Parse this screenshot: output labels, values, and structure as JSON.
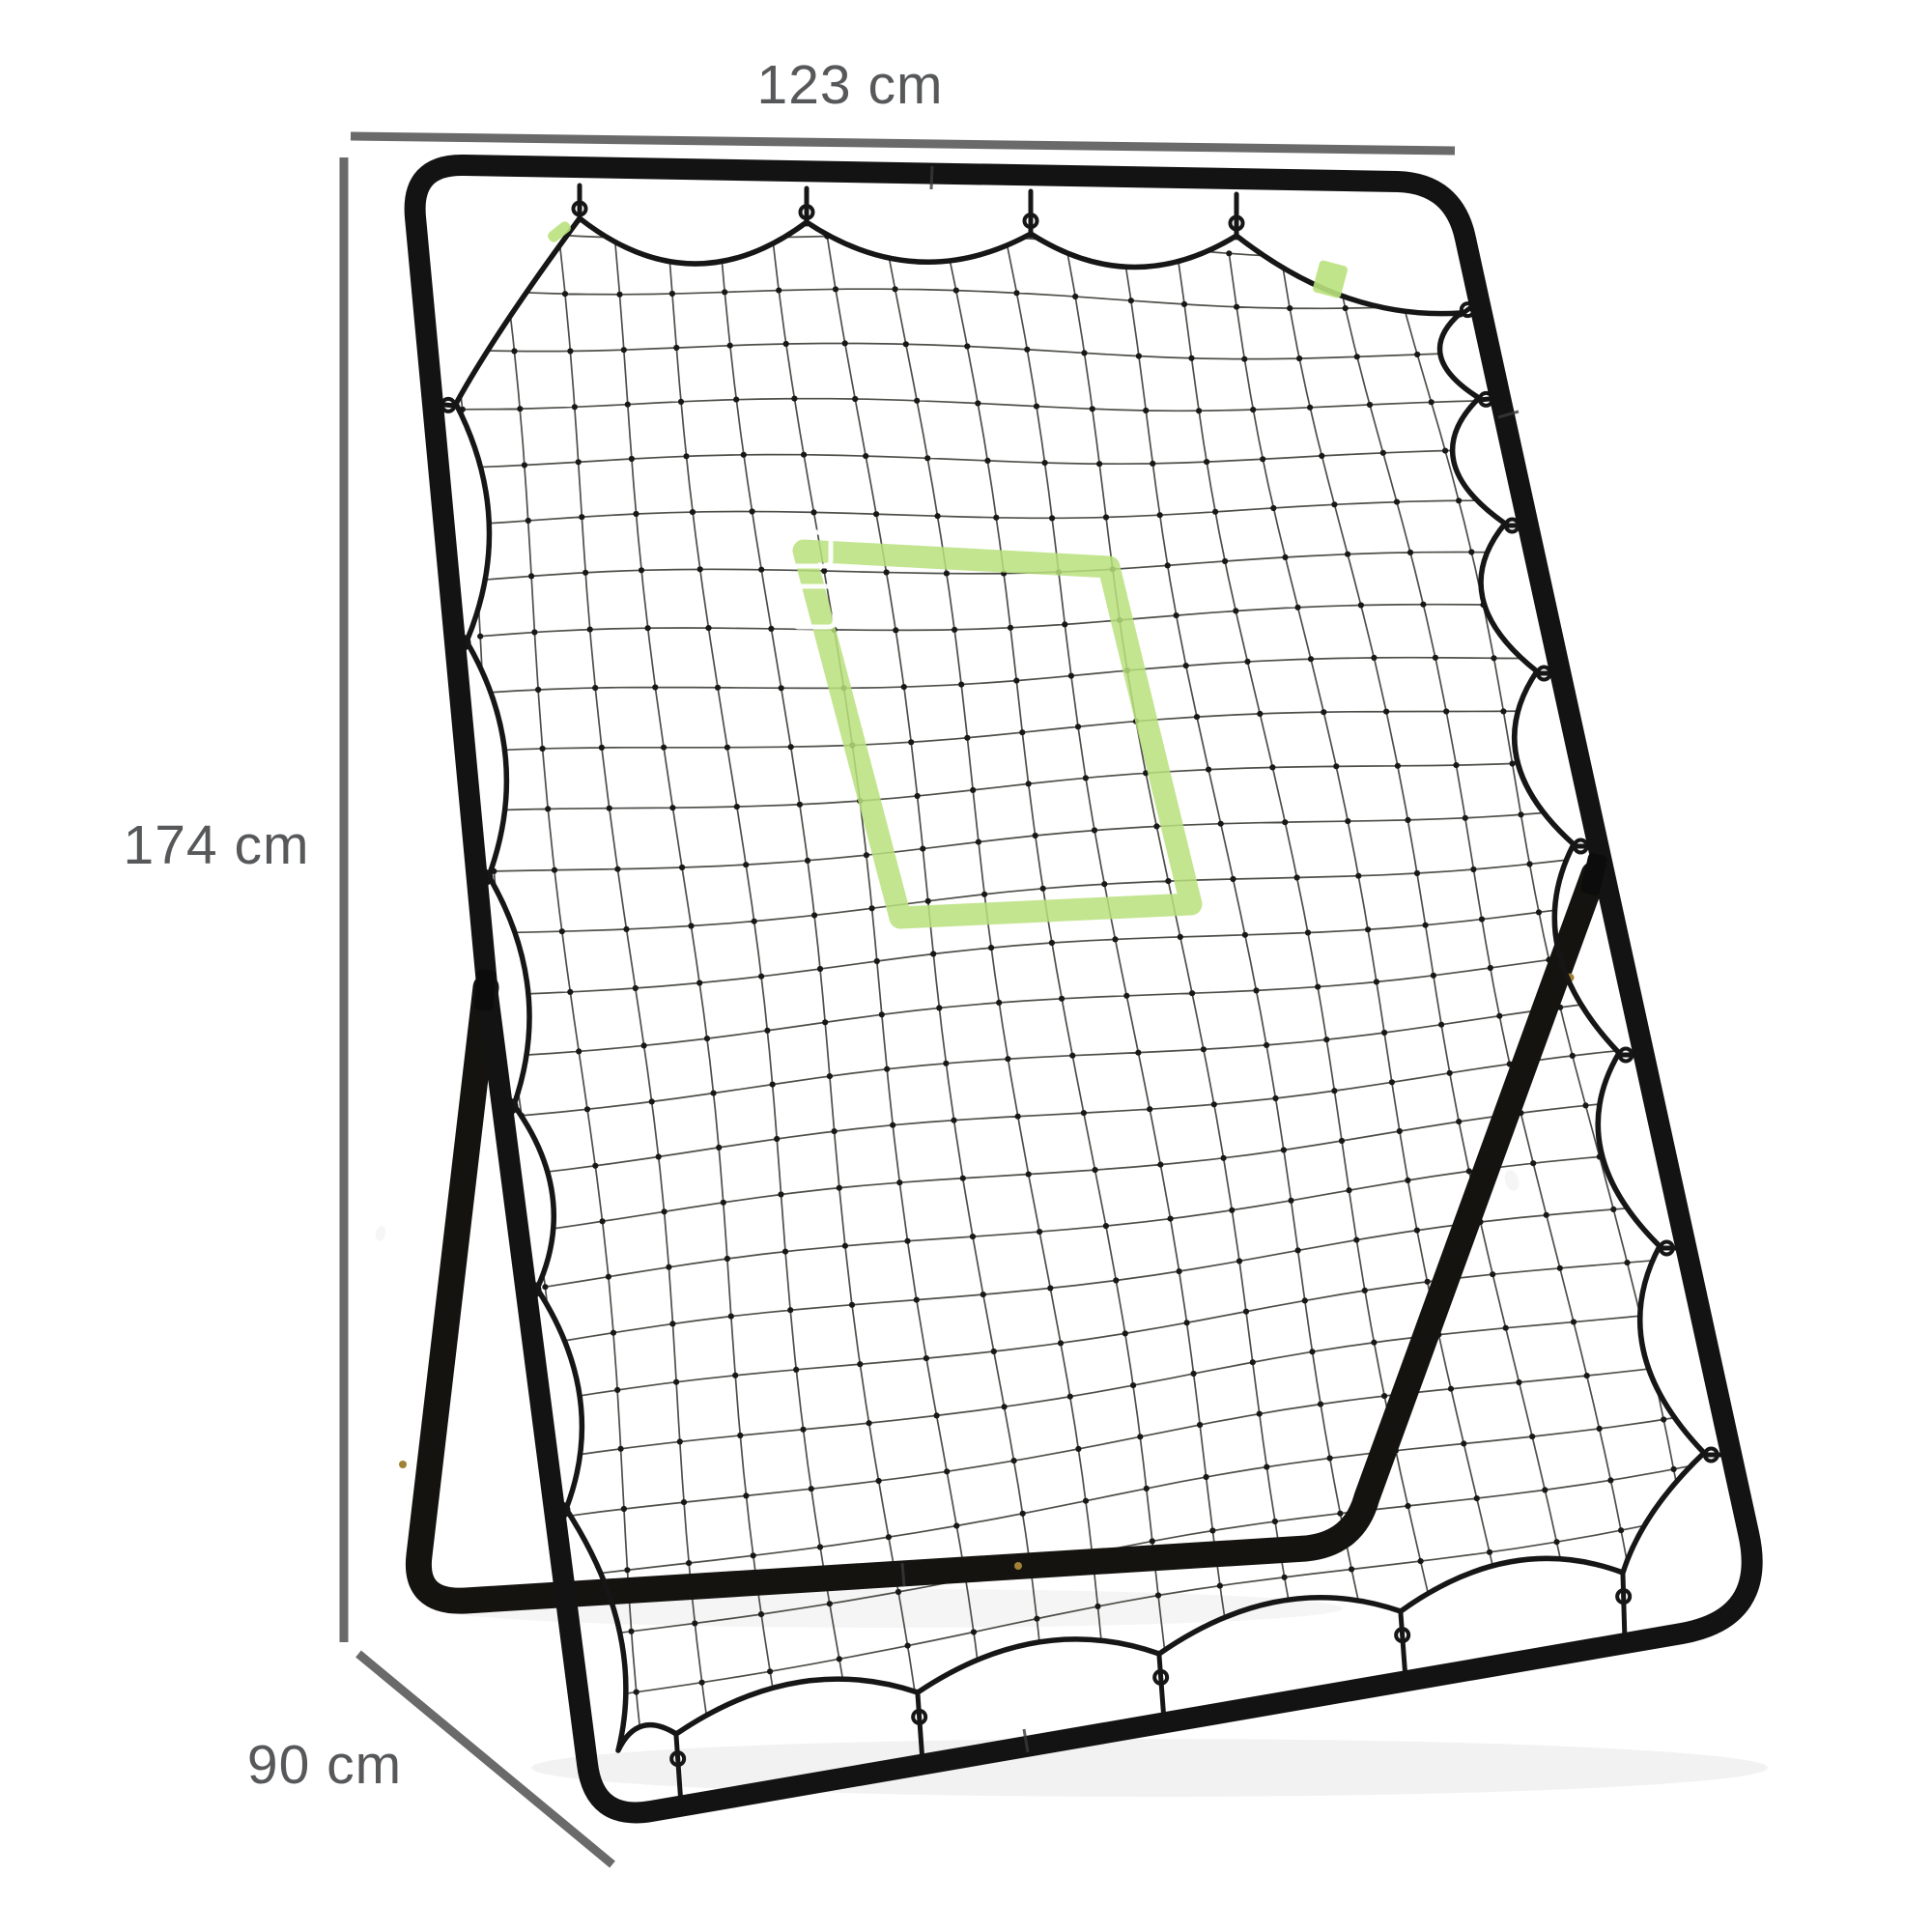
{
  "annotations": {
    "width": {
      "label": "123 cm"
    },
    "height": {
      "label": "174 cm"
    },
    "depth": {
      "label": "90 cm"
    }
  },
  "colors": {
    "background": "#ffffff",
    "dimension_line": "#6a6a6a",
    "dimension_text": "#57585a",
    "frame": "#131313",
    "stand": "#15130f",
    "net_cord": "#161616",
    "net_line": "#45453f",
    "net_knot": "#181818",
    "target_green": "#b9e17c",
    "patch_white": "#ffffff",
    "rivet_gold": "#a08136",
    "label_white": "#f5f5f5",
    "shadow": "#000000"
  }
}
